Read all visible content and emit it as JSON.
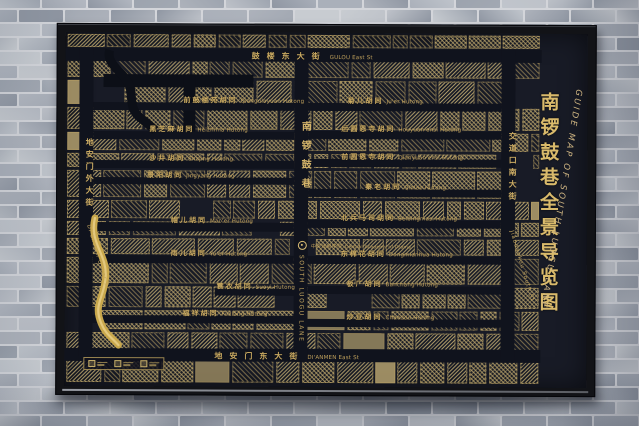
{
  "sign": {
    "title": {
      "cn": "南锣鼓巷全景导览图",
      "en": "GUIDE MAP OF SOUTH LUOGU LANE"
    },
    "map": {
      "streets": {
        "gulou": {
          "cn": "鼓楼东大街",
          "en": "GULOU East St"
        },
        "dianmen_east": {
          "cn": "地安门东大街",
          "en": "DI'ANMEN East St"
        },
        "dianmen_outer": {
          "cn": "地安门外大街",
          "en": "Di'anmen Outer St"
        },
        "south_luogu": {
          "cn": "南锣鼓巷",
          "en": "SOUTH LUOGU LANE"
        },
        "jiaodaokou": {
          "cn": "交道口南大街",
          "en": "Jiaodaokou South St"
        }
      },
      "hutongs": {
        "qianguloyuan": {
          "cn": "前鼓楼苑胡同",
          "en": "Qianguloyuan Hutong"
        },
        "heizhima": {
          "cn": "黑芝麻胡同",
          "en": "Heizhima Hutong"
        },
        "shajing": {
          "cn": "沙井胡同",
          "en": "Shajing Hutong"
        },
        "jingyang": {
          "cn": "景阳胡同",
          "en": "Jingyang Hutong"
        },
        "maoer": {
          "cn": "帽儿胡同",
          "en": "Mao'er Hutong"
        },
        "yuer": {
          "cn": "雨儿胡同",
          "en": "Yu'er Hutong"
        },
        "suoyi": {
          "cn": "蓑衣胡同",
          "en": "Suoyi Hutong"
        },
        "fuxiang": {
          "cn": "福祥胡同",
          "en": "Fuxiang Hutong"
        },
        "juer": {
          "cn": "菊儿胡同",
          "en": "Ju'er Hutong"
        },
        "houyuanensi": {
          "cn": "后圆恩寺胡同",
          "en": "Houyuan'ensi Hutong"
        },
        "qianyuanensi": {
          "cn": "前圆恩寺胡同",
          "en": "Qianyuan'ensi Hutong"
        },
        "qinlao": {
          "cn": "秦老胡同",
          "en": "Qinlao Hutong"
        },
        "beibingmasi": {
          "cn": "北兵马司胡同",
          "en": "Beibingmasi Hutong"
        },
        "dongmianhua": {
          "cn": "东棉花胡同",
          "en": "Dongmianhua Hutong"
        },
        "banchang": {
          "cn": "板厂胡同",
          "en": "Banchang Hutong"
        },
        "chaodou": {
          "cn": "炒豆胡同",
          "en": "Chaodou Hutong"
        }
      },
      "landmarks": {
        "drama_academy": {
          "cn": "中央戏剧学院",
          "en": "Central Academy of Drama"
        }
      }
    },
    "colors": {
      "panel_bg": "#181b26",
      "frame": "#121317",
      "gold": "#cbab63",
      "title_gold": "#d9ba6b",
      "river": "#c9a84c",
      "wall_brick": "#b4b9c2",
      "wall_mortar": "#d3d5da"
    }
  }
}
